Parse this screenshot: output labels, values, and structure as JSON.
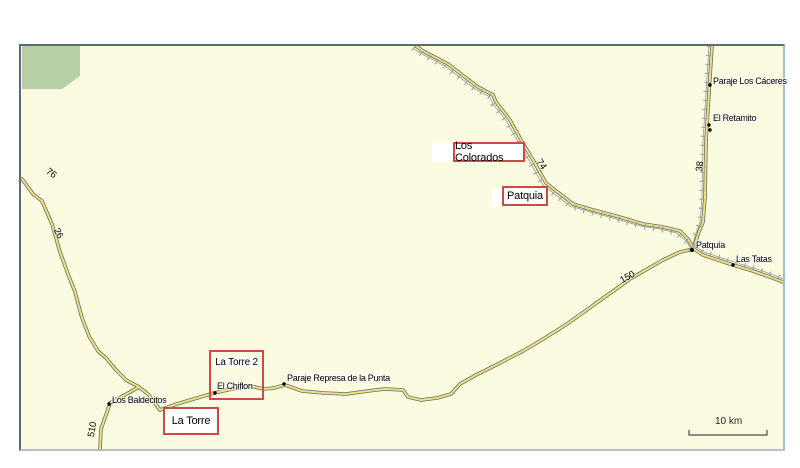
{
  "map": {
    "description": "Road map of the Patquía / Los Colorados area (La Rioja) with red annotation boxes",
    "scale_bar": {
      "label": "10 km"
    },
    "colors": {
      "map_background": "#fbfbe2",
      "land_area_green": "#b6cfa5",
      "road_fill": "#ede284",
      "road_casing": "#6b6b60",
      "railway_gray": "#9a9a9a",
      "annotation_box_red": "#cc4b45",
      "frame_dark": "#5a6b7d",
      "frame_light": "#a3bcd4",
      "label_text": "#000000"
    },
    "annotation_boxes": [
      {
        "id": "los-colorados",
        "label": "Los Colorados"
      },
      {
        "id": "patquia",
        "label": "Patquia"
      },
      {
        "id": "la-torre-2",
        "label": "La Torre 2"
      },
      {
        "id": "la-torre",
        "label": "La Torre"
      }
    ],
    "places": [
      {
        "id": "paraje-los-caceres",
        "name": "Paraje Los Cáceres"
      },
      {
        "id": "el-retamito",
        "name": "El Retamito"
      },
      {
        "id": "patquia-town",
        "name": "Patquía"
      },
      {
        "id": "las-tatas",
        "name": "Las Tatas"
      },
      {
        "id": "los-baldecitos",
        "name": "Los Baldecitos"
      },
      {
        "id": "el-chiflon",
        "name": "El Chiflon"
      },
      {
        "id": "paraje-represa-de-la-punta",
        "name": "Paraje Represa de la Punta"
      }
    ],
    "road_numbers": [
      {
        "ref": "76"
      },
      {
        "ref": "26"
      },
      {
        "ref": "510"
      },
      {
        "ref": "74"
      },
      {
        "ref": "38"
      },
      {
        "ref": "150"
      }
    ]
  }
}
